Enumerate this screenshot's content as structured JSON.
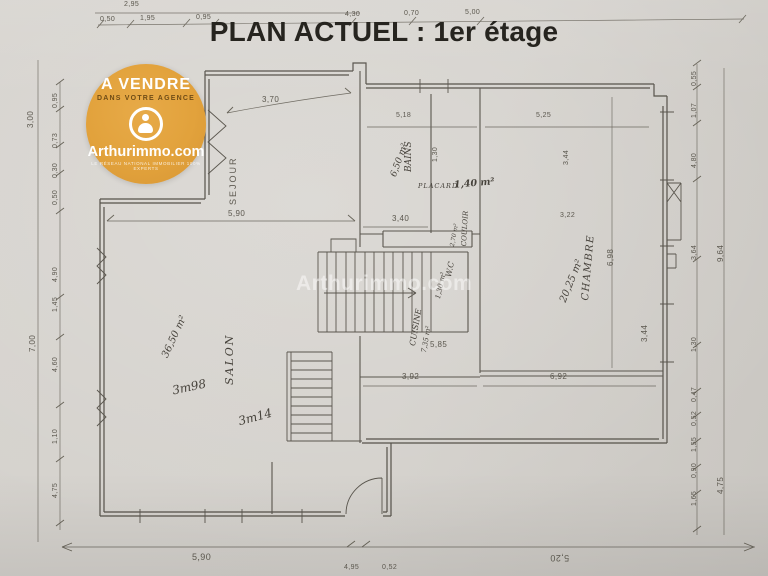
{
  "title": "PLAN ACTUEL : 1er étage",
  "watermark": "Arthurimmo.com",
  "badge": {
    "line1": "A VENDRE",
    "line2": "DANS VOTRE AGENCE",
    "brand": "Arthurimmo.com",
    "subtext": "LE RÉSEAU NATIONAL IMMOBILIER 100% EXPERTS",
    "color": "#E2A23C"
  },
  "rooms": {
    "sejour": {
      "label": "SEJOUR"
    },
    "salon": {
      "label": "SALON",
      "area": "36,50 m²"
    },
    "bains": {
      "label": "BAINS",
      "area": "6,50 m²"
    },
    "placard": {
      "label": "PLACARD",
      "area": "1,40 m²"
    },
    "couloir": {
      "label": "COULOIR",
      "area": "2,70 m²"
    },
    "wc": {
      "label": "W.C",
      "area": "1,30 m²"
    },
    "cuisine": {
      "label": "CUISINE",
      "area": "7,35 m²"
    },
    "chambre": {
      "label": "CHAMBRE",
      "area": "20,25 m²"
    }
  },
  "hand_dims": [
    "3m98",
    "3m14"
  ],
  "dims": {
    "top_outer": [
      "2,95"
    ],
    "top": [
      "0,50",
      "1,95",
      "0,95",
      "4,30",
      "0,70",
      "5,00"
    ],
    "left_outer": [
      "3,00",
      "7,00"
    ],
    "left": [
      "0,95",
      "0,73",
      "0,30",
      "0,50",
      "4,90",
      "1,45",
      "4,60",
      "1,10",
      "4,75"
    ],
    "right": [
      "0,55",
      "1,07",
      "4,80",
      "3,64",
      "1,30",
      "0,47",
      "0,52",
      "1,55",
      "0,90",
      "1,65"
    ],
    "right_outer": [
      "9,64",
      "4,75"
    ],
    "bottom": [
      "5,90",
      "4,95",
      "0,52",
      "5,20"
    ],
    "interior": [
      "3,70",
      "5,90",
      "3,40",
      "5,18",
      "1,30",
      "5,25",
      "3,44",
      "3,22",
      "6,98",
      "5,85",
      "3,92",
      "6,92",
      "3,44"
    ]
  }
}
